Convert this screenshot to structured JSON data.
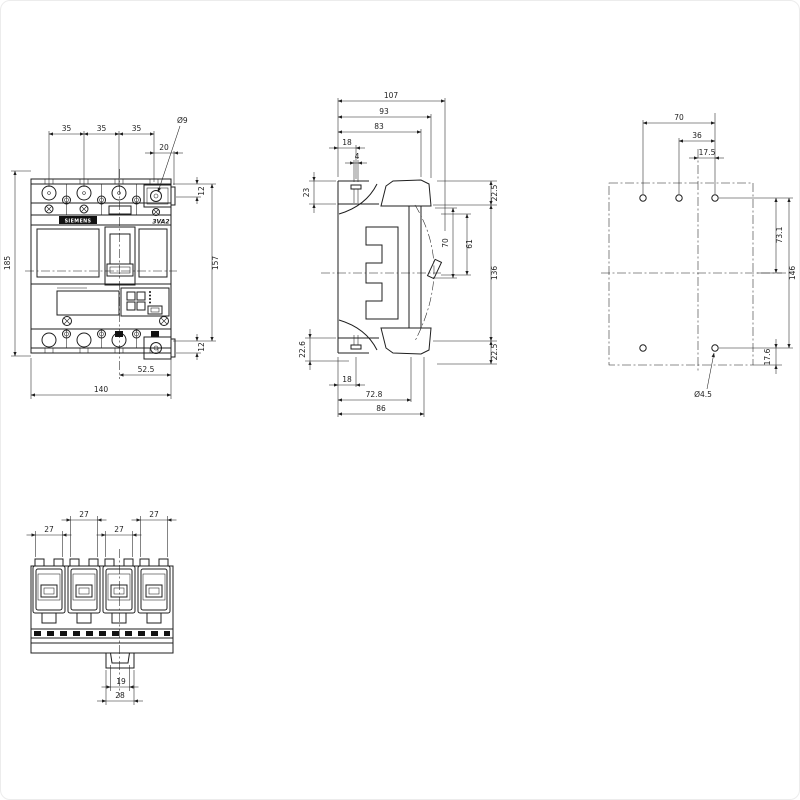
{
  "product": {
    "brand": "SIEMENS",
    "model": "3VA2"
  },
  "front_view": {
    "pole_pitch_dims": [
      "35",
      "35",
      "35"
    ],
    "terminal_offset_dim": "20",
    "terminal_hole_label": "Ø9",
    "right_dims": [
      "12",
      "157",
      "12"
    ],
    "overall_height_dim": "185",
    "bottom_dims": [
      "52.5",
      "140"
    ]
  },
  "side_view": {
    "top_dims": [
      "107",
      "93",
      "83",
      "18",
      "4"
    ],
    "left_dims": [
      "23",
      "22.6"
    ],
    "right_dims": [
      "22.5",
      "70",
      "61",
      "136",
      "22.5"
    ],
    "bottom_dims": [
      "18",
      "72.8",
      "86"
    ]
  },
  "mounting_view": {
    "top_dims": [
      "70",
      "36",
      "17.5"
    ],
    "right_dims": [
      "73.1",
      "146",
      "17.6"
    ],
    "hole_label": "Ø4.5"
  },
  "bottom_view": {
    "terminal_width_dims": [
      "27",
      "27",
      "27",
      "27"
    ],
    "rail_dims": [
      "19",
      "28"
    ]
  },
  "colors": {
    "line": "#1f1f1f",
    "background": "#ffffff",
    "label_bg": "#111111",
    "label_text": "#ffffff"
  }
}
